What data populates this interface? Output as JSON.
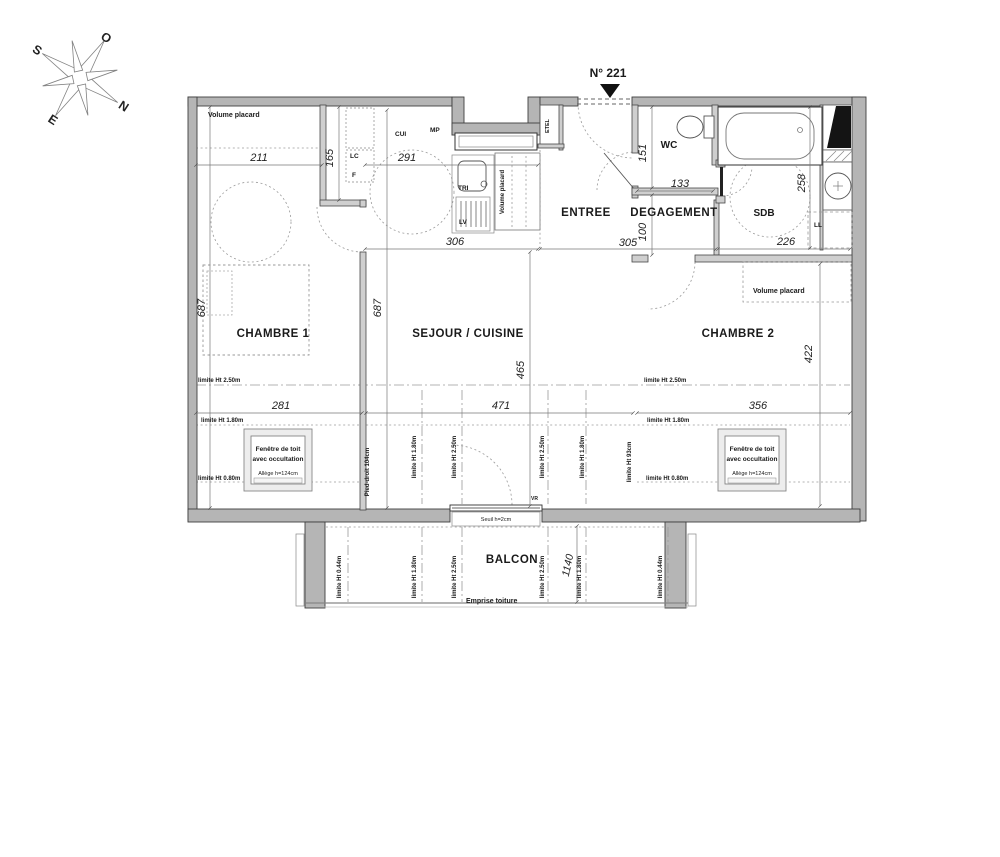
{
  "title": {
    "unit": "N° 221"
  },
  "compass": {
    "n": "N",
    "s": "S",
    "e": "E",
    "o": "O"
  },
  "rooms": {
    "chambre1": "CHAMBRE 1",
    "sejour_cuisine": "SEJOUR / CUISINE",
    "entree": "ENTREE",
    "degagement": "DEGAGEMENT",
    "wc": "WC",
    "sdb": "SDB",
    "chambre2": "CHAMBRE 2",
    "balcon": "BALCON"
  },
  "dims": {
    "d211": "211",
    "d165": "165",
    "d291": "291",
    "d306": "306",
    "d305": "305",
    "d151": "151",
    "d133": "133",
    "d226": "226",
    "d258": "258",
    "d100": "100",
    "d687": "687",
    "d465": "465",
    "d422": "422",
    "d281": "281",
    "d471": "471",
    "d356": "356",
    "d1140": "1140"
  },
  "annotations": {
    "volume_placard": "Volume placard",
    "limite_250": "limite Ht 2.50m",
    "limite_180": "limite Ht 1.80m",
    "limite_080": "limite Ht 0.80m",
    "limite_044": "limite Ht 0.44m",
    "limite_93": "limite Ht 93cm",
    "fenetre_1": "Fenêtre de toit",
    "fenetre_2": "avec occultation",
    "allege": "Allège h=124cm",
    "pied_droit": "Pied-droit 104cm",
    "seuil": "Seuil h=2cm",
    "emprise": "Emprise toiture"
  },
  "fixtures": {
    "cui": "CUI",
    "mp": "MP",
    "lc": "LC",
    "f": "F",
    "tri": "TRI",
    "lv": "LV",
    "etel": "ETEL",
    "ll": "LL",
    "vr": "VR"
  },
  "colors": {
    "wall": "#b5b5b5",
    "line": "#9a9a9a",
    "text": "#1a1a1a"
  }
}
